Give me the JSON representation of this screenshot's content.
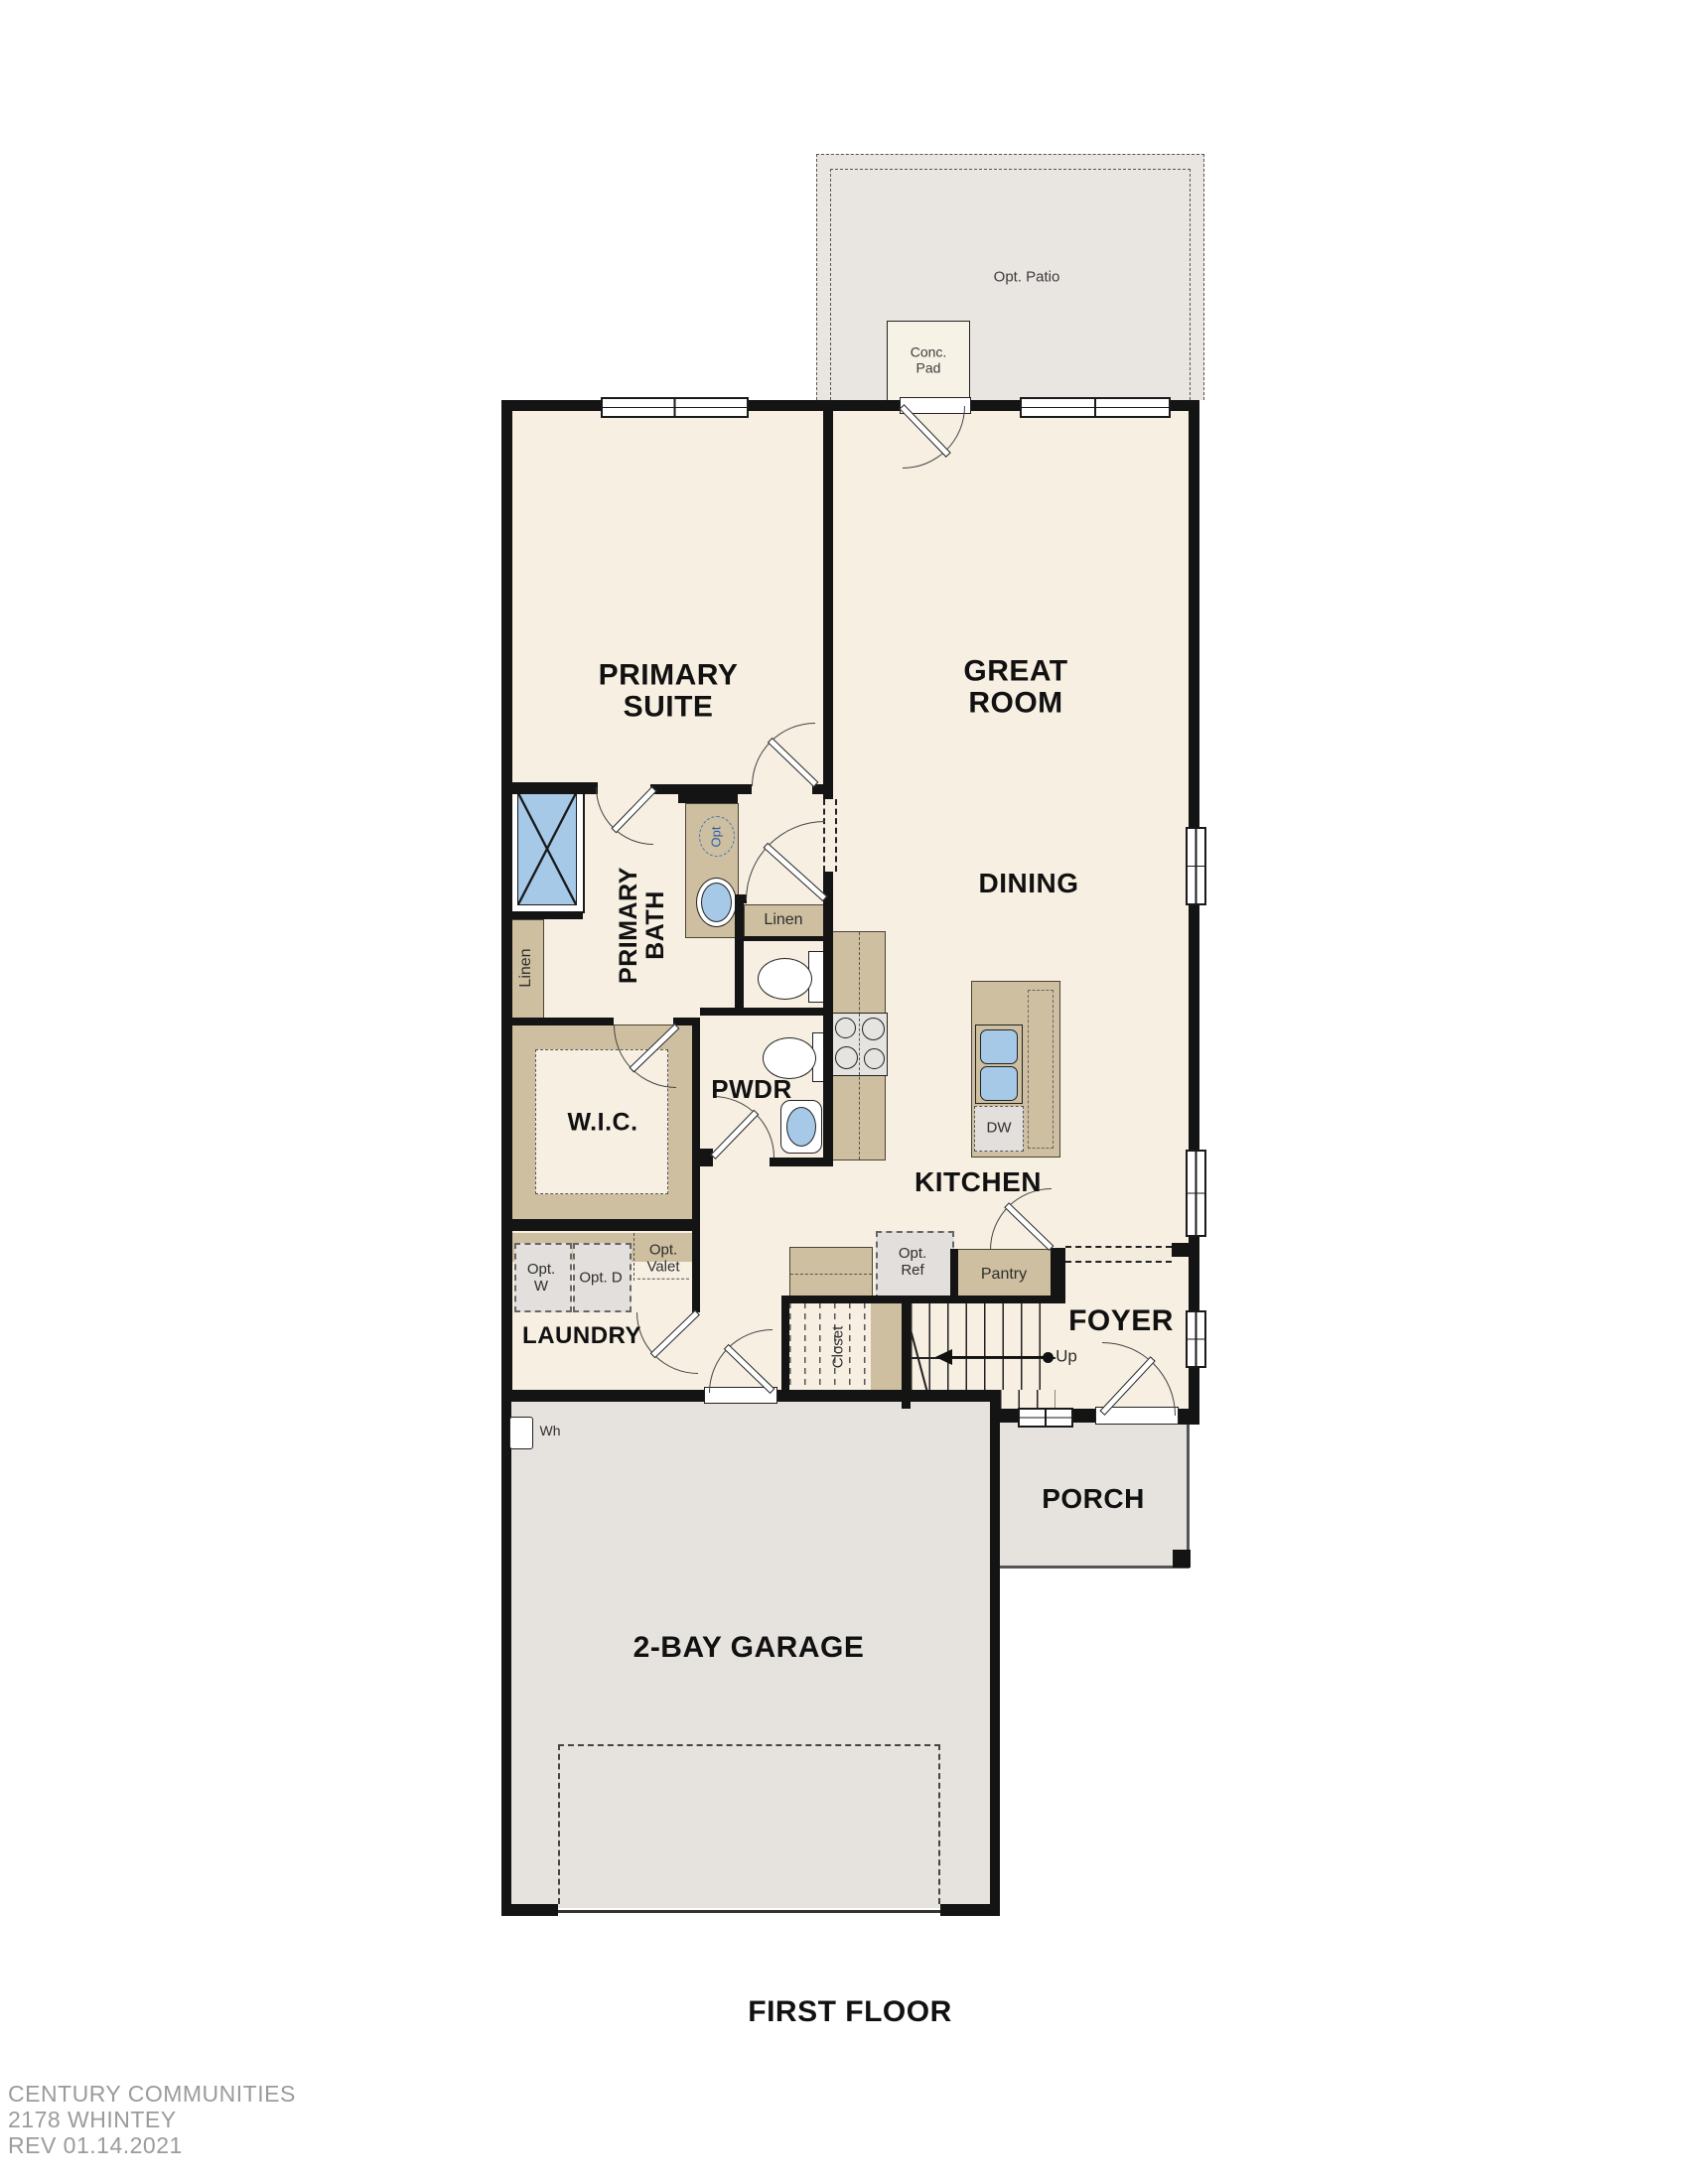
{
  "plan": {
    "title": "FIRST FLOOR",
    "footer_line1": "CENTURY COMMUNITIES",
    "footer_line2": "2178 WHINTEY",
    "footer_line3": "REV 01.14.2021"
  },
  "labels": {
    "opt_patio": "Opt. Patio",
    "conc_pad": "Conc. Pad",
    "primary_suite": "PRIMARY SUITE",
    "great_room": "GREAT ROOM",
    "dining": "DINING",
    "primary_bath": "PRIMARY BATH",
    "linen_left": "Linen",
    "linen_right": "Linen",
    "wic": "W.I.C.",
    "pwdr": "PWDR",
    "opt_fixture": "Opt",
    "kitchen": "KITCHEN",
    "dw": "DW",
    "laundry": "LAUNDRY",
    "opt_w": "Opt. W",
    "opt_d": "Opt. D",
    "opt_valet": "Opt. Valet",
    "opt_ref": "Opt. Ref",
    "pantry": "Pantry",
    "closet": "Closet",
    "up": "Up",
    "foyer": "FOYER",
    "porch": "PORCH",
    "garage": "2-BAY GARAGE",
    "wh": "Wh"
  },
  "colors": {
    "wall": "#141414",
    "floor": "#f6efe2",
    "cabinet_tan": "#cdbf9f",
    "exterior_gray": "#e6e3df",
    "appliance_gray": "#e2dfdd",
    "fixture_blue": "#a6c9e8",
    "optional_blue": "#4a78b5",
    "footer_gray": "#9b9b9b"
  }
}
